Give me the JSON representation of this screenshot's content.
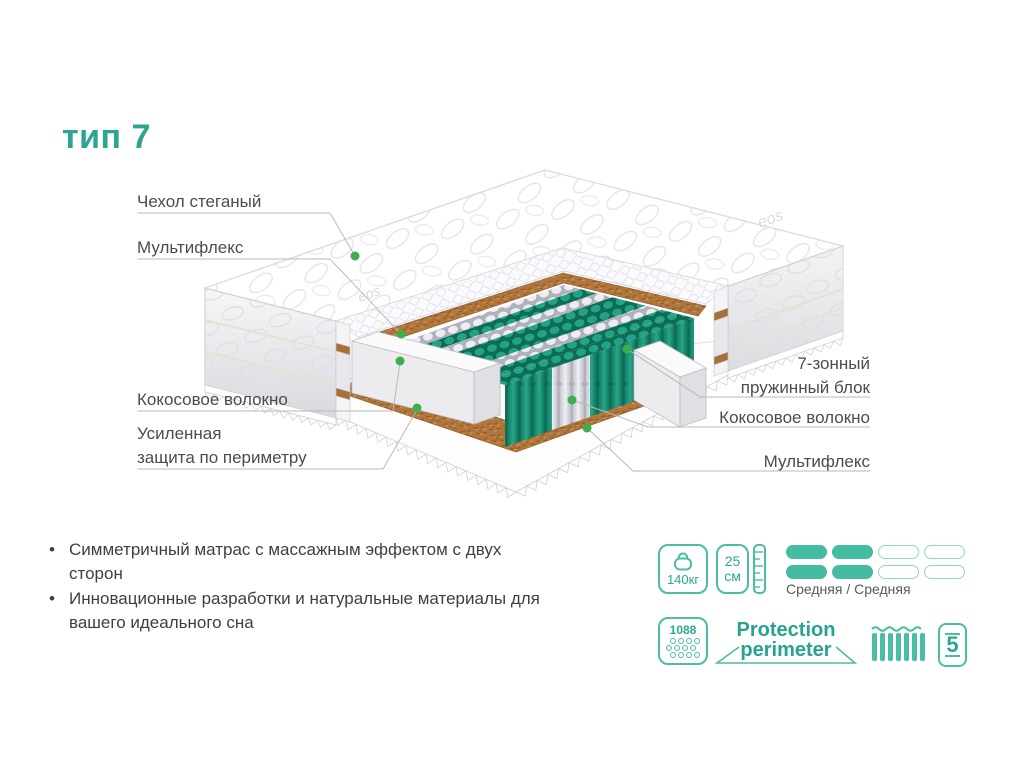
{
  "title": "тип 7",
  "watermark": "eos",
  "labels": {
    "cover": "Чехол стеганый",
    "multiflex_top": "Мультифлекс",
    "coconut_left": "Кокосовое волокно",
    "perimeter_line1": "Усиленная",
    "perimeter_line2": "защита по периметру",
    "spring_block_line1": "7-зонный",
    "spring_block_line2": "пружинный блок",
    "coconut_right": "Кокосовое волокно",
    "multiflex_bottom": "Мультифлекс"
  },
  "features": [
    "Симметричный матрас с массажным эффектом с двух сторон",
    "Инновационные разработки и натуральные материалы для вашего идеального сна"
  ],
  "specs": {
    "max_weight": "140кг",
    "height_value": "25",
    "height_unit": "см",
    "firmness_label": "Средняя / Средняя",
    "springs_count": "1088",
    "protection_line1": "Protection",
    "protection_line2": "perimeter",
    "warranty": "5"
  },
  "colors": {
    "accent_teal": "#2EA592",
    "icon_teal": "#44BCA3",
    "spring_green": "#1F997C",
    "coconut_brown": "#B1763C",
    "dot_green": "#3DAF4C",
    "label_gray": "#4C4C4C"
  }
}
